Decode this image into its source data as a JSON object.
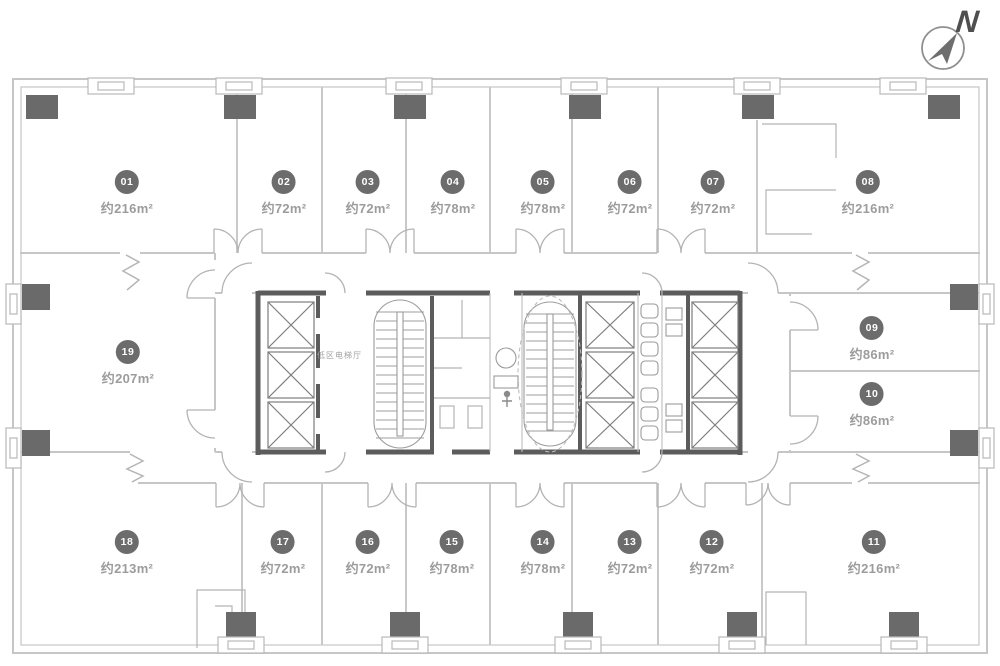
{
  "compass": {
    "label": "N"
  },
  "core": {
    "elevator_hall_label": "低区电梯厅"
  },
  "colors": {
    "badge": "#6c6c6c",
    "area_text": "#9c9c9c",
    "wall_light": "#c6c6c6",
    "wall_dark": "#5c5c5c",
    "column_fill": "#6a6a6a"
  },
  "units": [
    {
      "id": "01",
      "area": "约216m²"
    },
    {
      "id": "02",
      "area": "约72m²"
    },
    {
      "id": "03",
      "area": "约72m²"
    },
    {
      "id": "04",
      "area": "约78m²"
    },
    {
      "id": "05",
      "area": "约78m²"
    },
    {
      "id": "06",
      "area": "约72m²"
    },
    {
      "id": "07",
      "area": "约72m²"
    },
    {
      "id": "08",
      "area": "约216m²"
    },
    {
      "id": "09",
      "area": "约86m²"
    },
    {
      "id": "10",
      "area": "约86m²"
    },
    {
      "id": "11",
      "area": "约216m²"
    },
    {
      "id": "12",
      "area": "约72m²"
    },
    {
      "id": "13",
      "area": "约72m²"
    },
    {
      "id": "14",
      "area": "约78m²"
    },
    {
      "id": "15",
      "area": "约78m²"
    },
    {
      "id": "16",
      "area": "约72m²"
    },
    {
      "id": "17",
      "area": "约72m²"
    },
    {
      "id": "18",
      "area": "约213m²"
    },
    {
      "id": "19",
      "area": "约207m²"
    }
  ]
}
